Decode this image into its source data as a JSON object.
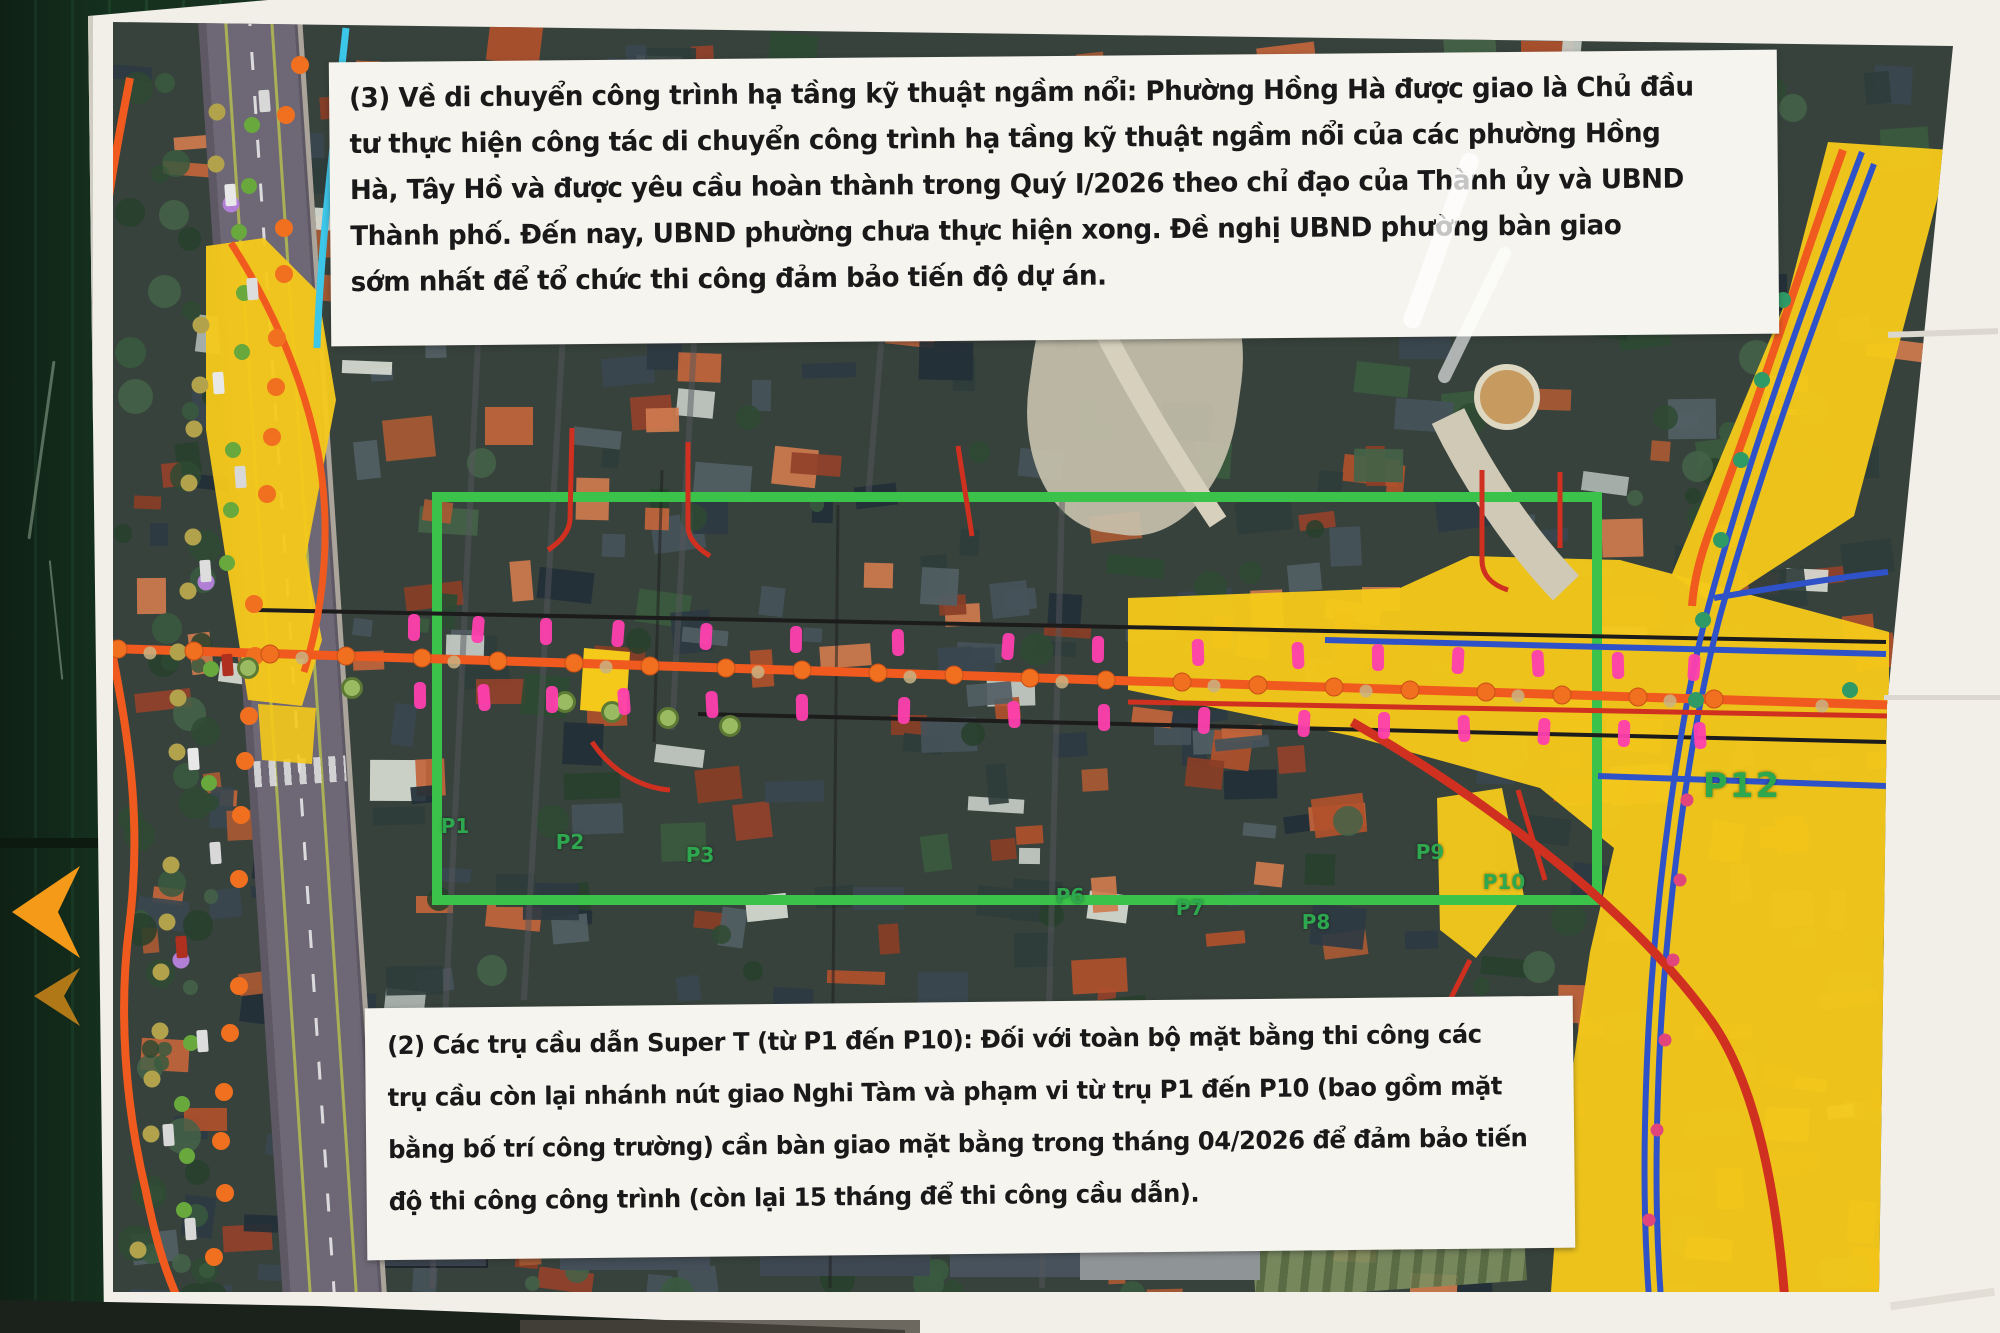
{
  "notes": {
    "note3": {
      "lines": [
        "(3) Về di chuyển công trình hạ tầng kỹ thuật ngầm nổi: Phường Hồng Hà được giao là Chủ đầu",
        "tư thực hiện công tác di chuyển công trình hạ tầng kỹ thuật ngầm nổi của các phường Hồng",
        "Hà, Tây Hồ và được yêu cầu hoàn thành trong Quý I/2026 theo chỉ đạo của Thành ủy và UBND",
        "Thành phố. Đến nay, UBND phường chưa thực hiện xong. Đề nghị UBND phường bàn giao",
        "sớm nhất để tổ chức thi công đảm bảo tiến độ dự án."
      ]
    },
    "note2": {
      "lines": [
        "(2) Các trụ cầu dẫn Super T (từ P1 đến P10): Đối với toàn bộ mặt bằng thi công các",
        "trụ cầu còn lại nhánh nút giao Nghi Tàm và phạm vi từ trụ P1 đến P10 (bao gồm mặt",
        "bằng bố trí công trường) cần bàn giao mặt bằng trong tháng 04/2026 để đảm bảo tiến",
        "độ thi công công trình (còn lại 15 tháng để thi công cầu dẫn)."
      ]
    }
  },
  "map": {
    "pier_labels": [
      {
        "text": "P1",
        "x": 455,
        "y": 826
      },
      {
        "text": "P2",
        "x": 570,
        "y": 842
      },
      {
        "text": "P3",
        "x": 700,
        "y": 855
      },
      {
        "text": "P6",
        "x": 1070,
        "y": 896
      },
      {
        "text": "P7",
        "x": 1190,
        "y": 908
      },
      {
        "text": "P8",
        "x": 1316,
        "y": 922
      },
      {
        "text": "P9",
        "x": 1430,
        "y": 852
      },
      {
        "text": "P10",
        "x": 1504,
        "y": 882
      },
      {
        "text": "P12",
        "x": 1742,
        "y": 786,
        "big": true
      }
    ],
    "pier_markers": {
      "xs": [
        408,
        472,
        540,
        612,
        700,
        790,
        892,
        1002,
        1092,
        1192,
        1292,
        1372,
        1452,
        1532,
        1612,
        1688
      ]
    },
    "curve_dots": {
      "teal": [
        [
          1783,
          300
        ],
        [
          1762,
          380
        ],
        [
          1741,
          460
        ],
        [
          1721,
          540
        ],
        [
          1703,
          620
        ],
        [
          1696,
          700
        ],
        [
          1850,
          690
        ]
      ],
      "red": [
        [
          1687,
          800
        ],
        [
          1680,
          880
        ],
        [
          1673,
          960
        ],
        [
          1665,
          1040
        ],
        [
          1657,
          1130
        ],
        [
          1649,
          1220
        ],
        [
          1642,
          1300
        ]
      ]
    },
    "colors": {
      "fence": "#16321f",
      "fence_rib": "#1d4129",
      "paper": "#f2efe8",
      "note_paper": "#f6f4ee",
      "map_base": "#37423c",
      "yellow": "#f5c91a",
      "green_rect": "#3bc24a",
      "orange_line": "#f05a1e",
      "red_line": "#d03020",
      "black_line": "#1c1c1c",
      "blue_line": "#2f52c9",
      "cyan": "#3cc6e8",
      "pink": "#ff3fae",
      "label_green": "#2ea84e",
      "dot_orange": "#f07020",
      "dot_olive": "#b3a24c",
      "dot_green": "#68a83c",
      "dot_purple": "#b27fd6",
      "teal_dot": "#2f9a66",
      "red_dot": "#e0457b",
      "arrow": "#f59a18"
    }
  }
}
